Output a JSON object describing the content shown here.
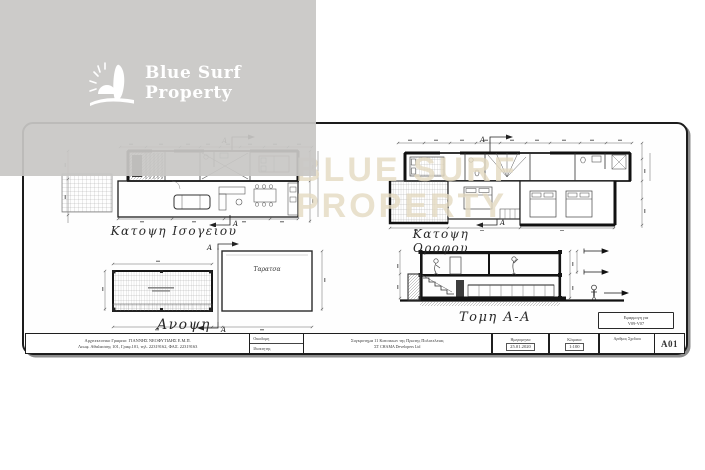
{
  "brand": {
    "line1": "Blue Surf",
    "line2": "Property"
  },
  "watermark": {
    "line1": "BLUE SURF",
    "line2": "PROPERTY"
  },
  "drawings": {
    "ground_floor": {
      "label": "Κατοψη Ισογειου",
      "marker_top": "A",
      "marker_bottom": "A"
    },
    "upper_floor": {
      "label": "Κατοψη Οροφου",
      "marker_top": "A",
      "marker_bottom": "A"
    },
    "roof": {
      "label": "Ανοψη",
      "terrace": "Ταρατσα",
      "marker_top": "A",
      "marker_bottom": "A"
    },
    "section": {
      "label": "Τομη Α-Α"
    }
  },
  "titleblock": {
    "office_line1": "Αρχιτεκτονικο Γραφειο: ΓΙΑΝΝΗΣ ΝΕΟΦΥΤΙΔΗΣ Ε.Μ.Π.",
    "office_line2": "Λεωφ. Αθαλασσης 101, Γραφ.101, τηλ. 22319162, ΦΑΞ. 22319163",
    "row1_label": "Οικοδομη",
    "row2_label": "Ιδιοκτητης",
    "project_line1": "Συγκροτημα 11 Κατοικιων της Πρωτης Πολυτελειας",
    "project_line2": "ΣΤ CHAMA Developers Ltd",
    "date_label": "Ημερομηνια",
    "date_value": "25.01.2020",
    "scale_label": "Κλιμακα",
    "scale_value": "1:100",
    "sheet_no_label": "Αριθμος Σχεδιου",
    "sheet_code": "A01",
    "ref_line1": "Εφαρμογη για",
    "ref_line2": "V09-V07"
  },
  "colors": {
    "band": "#c8c7c5",
    "card_border": "#1c1c1c",
    "watermark_beige": "#e4d9c1",
    "ink": "#2b2b2b"
  }
}
